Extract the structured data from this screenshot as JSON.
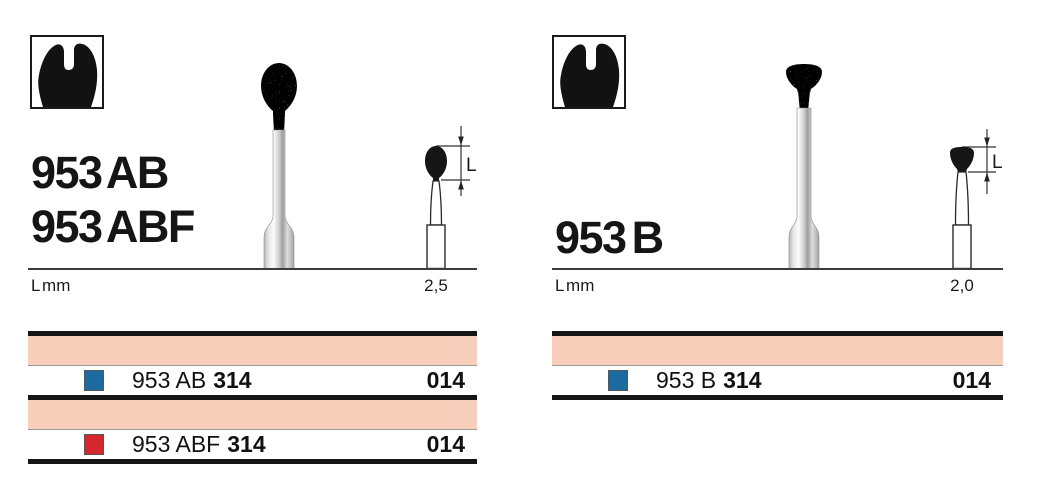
{
  "colors": {
    "salmon": "#f8cfba",
    "blue": "#1b6aa0",
    "red": "#d6262e"
  },
  "sections": [
    {
      "titles": [
        "953 AB",
        "953 ABF"
      ],
      "axis_label": "L mm",
      "length_value": "2,5",
      "dimension_letter": "L",
      "rows": [
        {
          "swatch_color": "blue",
          "code": "953 AB",
          "iso": "314",
          "size": "014"
        },
        {
          "swatch_color": "red",
          "code": "953 ABF",
          "iso": "314",
          "size": "014"
        }
      ]
    },
    {
      "titles": [
        "953 B"
      ],
      "axis_label": "L mm",
      "length_value": "2,0",
      "dimension_letter": "L",
      "rows": [
        {
          "swatch_color": "blue",
          "code": "953 B",
          "iso": "314",
          "size": "014"
        }
      ]
    }
  ]
}
